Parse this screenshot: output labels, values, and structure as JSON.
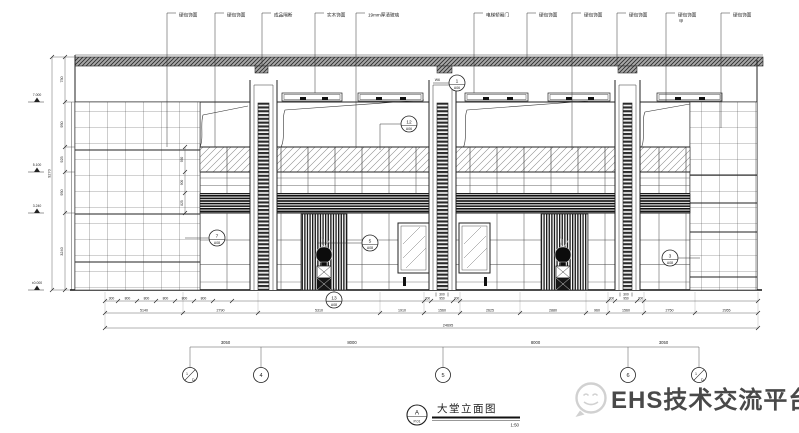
{
  "drawing": {
    "type": "architectural-elevation",
    "top_callouts": [
      {
        "text": "硬包饰面"
      },
      {
        "text": "硬包饰面"
      },
      {
        "text": "成品隔断"
      },
      {
        "text": "实木饰面"
      },
      {
        "text": "19mm厚清玻璃"
      },
      {
        "text": "电梯轿厢门"
      },
      {
        "text": "硬包饰面"
      },
      {
        "text": "硬包饰面"
      },
      {
        "text": "硬包饰面"
      },
      {
        "text": "硬包饰面",
        "text2": "甲"
      },
      {
        "text": "硬包饰面"
      }
    ],
    "detail_bubbles": [
      {
        "num": "12",
        "sheet": "A06"
      },
      {
        "num": "1",
        "sheet": "A06",
        "prefix": "W6"
      },
      {
        "num": "5",
        "sheet": "A08"
      },
      {
        "num": "7",
        "sheet": "A08"
      },
      {
        "num": "3",
        "sheet": "A08"
      },
      {
        "num": "13",
        "sheet": "A08"
      }
    ],
    "elevation_markers": [
      {
        "label": "7.000"
      },
      {
        "label": "5.100"
      },
      {
        "label": "3.240"
      },
      {
        "label": "±0.000"
      }
    ],
    "dims_left": {
      "total": "9270",
      "segments": [
        "750",
        "950",
        "925",
        "950",
        "3240"
      ],
      "inner": [
        "950",
        "900",
        "825"
      ]
    },
    "dims_bottom": {
      "row1": [
        "300",
        "800",
        "800",
        "800",
        "800",
        "800"
      ],
      "cluster": [
        "300",
        "950",
        "300"
      ],
      "door_opening": "300",
      "row2": [
        "5140",
        "2790",
        "5310",
        "1910",
        "1560",
        "2625",
        "2880",
        "960",
        "1560",
        "2750",
        "2955"
      ],
      "row3_total": "24695"
    },
    "axis": {
      "dims": [
        "3050",
        "8000",
        "8000",
        "3050"
      ],
      "bubbles": [
        {
          "slashed": true,
          "top": "1",
          "bottom": "D"
        },
        {
          "label": "4"
        },
        {
          "label": "5"
        },
        {
          "label": "6"
        },
        {
          "slashed": true,
          "top": "1",
          "bottom": "D"
        }
      ]
    }
  },
  "title_block": {
    "tag": "A",
    "sheet": "P.01",
    "title": "大堂立面图",
    "scale": "1:50"
  },
  "watermark": {
    "logo": "wechat-chat-bubble-icon",
    "text": "EHS技术交流平台"
  }
}
